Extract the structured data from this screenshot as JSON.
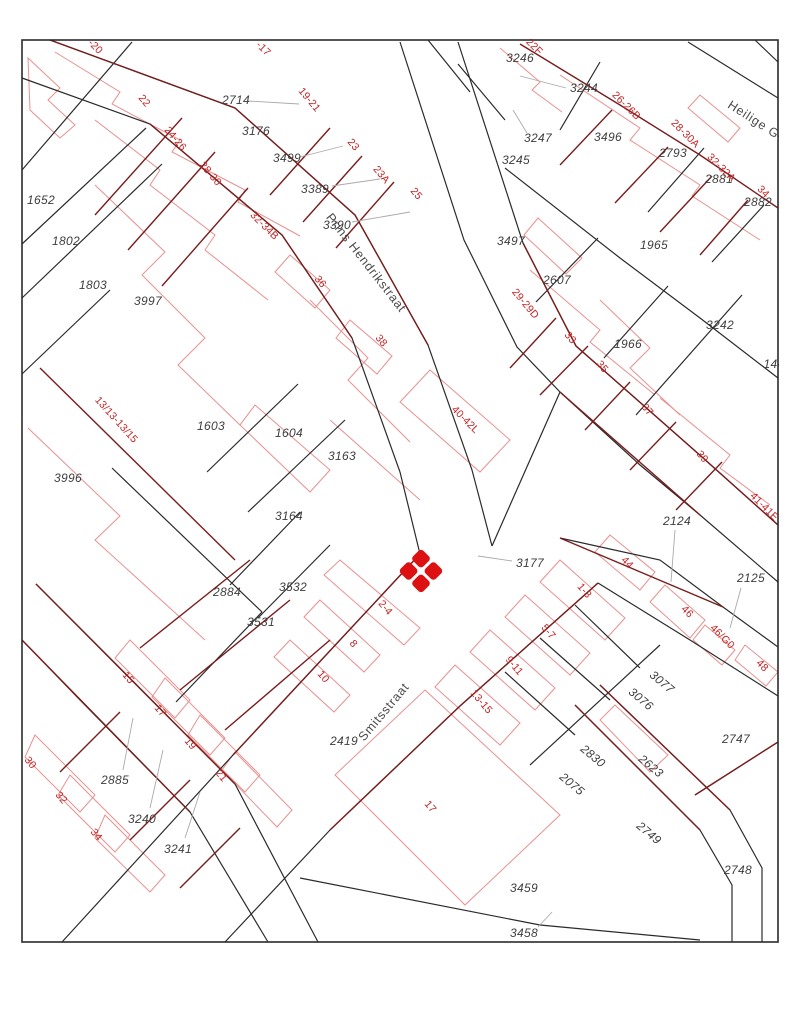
{
  "map": {
    "type": "cadastral-parcel-map",
    "colors": {
      "background": "#ffffff",
      "parcel_line": "#2b2b2b",
      "frontage_line": "#7a1d1d",
      "building_line": "#e89090",
      "parcel_label": "#3d3d3d",
      "house_label": "#c42222",
      "street_label": "#4a4a4a",
      "leader_line": "#aaaaaa",
      "marker": "#dd1111"
    },
    "marker": {
      "x": 421,
      "y": 571,
      "color": "#dd1111"
    },
    "streets": [
      {
        "name": "Prins Hendrikstraat",
        "x": 366,
        "y": 263,
        "rotation": 52
      },
      {
        "name": "Smitsstraat",
        "x": 384,
        "y": 712,
        "rotation": -50
      },
      {
        "name": "Heilige Gee",
        "x": 760,
        "y": 124,
        "rotation": 33
      }
    ],
    "parcel_numbers": [
      {
        "text": "2714",
        "x": 236,
        "y": 100,
        "rotation": 0
      },
      {
        "text": "3176",
        "x": 256,
        "y": 131,
        "rotation": 0
      },
      {
        "text": "3499",
        "x": 287,
        "y": 158,
        "rotation": 0
      },
      {
        "text": "3389",
        "x": 315,
        "y": 189,
        "rotation": 0
      },
      {
        "text": "3390",
        "x": 337,
        "y": 225,
        "rotation": 0
      },
      {
        "text": "1652",
        "x": 41,
        "y": 200,
        "rotation": 0
      },
      {
        "text": "1802",
        "x": 66,
        "y": 241,
        "rotation": 0
      },
      {
        "text": "1803",
        "x": 93,
        "y": 285,
        "rotation": 0
      },
      {
        "text": "3997",
        "x": 148,
        "y": 301,
        "rotation": 0
      },
      {
        "text": "3246",
        "x": 520,
        "y": 58,
        "rotation": 0
      },
      {
        "text": "3244",
        "x": 584,
        "y": 88,
        "rotation": 0
      },
      {
        "text": "3247",
        "x": 538,
        "y": 138,
        "rotation": 0
      },
      {
        "text": "3496",
        "x": 608,
        "y": 137,
        "rotation": 0
      },
      {
        "text": "3245",
        "x": 516,
        "y": 160,
        "rotation": 0
      },
      {
        "text": "2793",
        "x": 673,
        "y": 153,
        "rotation": 0
      },
      {
        "text": "2881",
        "x": 719,
        "y": 179,
        "rotation": 0
      },
      {
        "text": "2882",
        "x": 758,
        "y": 202,
        "rotation": 0
      },
      {
        "text": "3497",
        "x": 511,
        "y": 241,
        "rotation": 0
      },
      {
        "text": "2607",
        "x": 557,
        "y": 280,
        "rotation": 0
      },
      {
        "text": "1965",
        "x": 654,
        "y": 245,
        "rotation": 0
      },
      {
        "text": "1966",
        "x": 628,
        "y": 344,
        "rotation": 0
      },
      {
        "text": "3242",
        "x": 720,
        "y": 325,
        "rotation": 0
      },
      {
        "text": "144",
        "x": 774,
        "y": 364,
        "rotation": 0
      },
      {
        "text": "1603",
        "x": 211,
        "y": 426,
        "rotation": 0
      },
      {
        "text": "1604",
        "x": 289,
        "y": 433,
        "rotation": 0
      },
      {
        "text": "3163",
        "x": 342,
        "y": 456,
        "rotation": 0
      },
      {
        "text": "3164",
        "x": 289,
        "y": 516,
        "rotation": 0
      },
      {
        "text": "3996",
        "x": 68,
        "y": 478,
        "rotation": 0
      },
      {
        "text": "2124",
        "x": 677,
        "y": 521,
        "rotation": 0
      },
      {
        "text": "2125",
        "x": 751,
        "y": 578,
        "rotation": 0
      },
      {
        "text": "2884",
        "x": 227,
        "y": 592,
        "rotation": 0
      },
      {
        "text": "3532",
        "x": 293,
        "y": 587,
        "rotation": 0
      },
      {
        "text": "3531",
        "x": 261,
        "y": 622,
        "rotation": 0
      },
      {
        "text": "3177",
        "x": 530,
        "y": 563,
        "rotation": 0
      },
      {
        "text": "2419",
        "x": 344,
        "y": 741,
        "rotation": 0
      },
      {
        "text": "2885",
        "x": 115,
        "y": 780,
        "rotation": 0
      },
      {
        "text": "3240",
        "x": 142,
        "y": 819,
        "rotation": 0
      },
      {
        "text": "3241",
        "x": 178,
        "y": 849,
        "rotation": 0
      },
      {
        "text": "3077",
        "x": 662,
        "y": 682,
        "rotation": 40
      },
      {
        "text": "3076",
        "x": 641,
        "y": 699,
        "rotation": 40
      },
      {
        "text": "2830",
        "x": 593,
        "y": 756,
        "rotation": 40
      },
      {
        "text": "2075",
        "x": 572,
        "y": 784,
        "rotation": 40
      },
      {
        "text": "2623",
        "x": 651,
        "y": 766,
        "rotation": 40
      },
      {
        "text": "2747",
        "x": 736,
        "y": 739,
        "rotation": 0
      },
      {
        "text": "2749",
        "x": 649,
        "y": 833,
        "rotation": 40
      },
      {
        "text": "2748",
        "x": 738,
        "y": 870,
        "rotation": 0
      },
      {
        "text": "3459",
        "x": 524,
        "y": 888,
        "rotation": 0
      },
      {
        "text": "3458",
        "x": 524,
        "y": 933,
        "rotation": 0
      }
    ],
    "house_numbers": [
      {
        "text": "-20",
        "x": 95,
        "y": 47,
        "rotation": 45
      },
      {
        "text": "-17",
        "x": 263,
        "y": 49,
        "rotation": 45
      },
      {
        "text": "22",
        "x": 144,
        "y": 101,
        "rotation": 50
      },
      {
        "text": "24-26",
        "x": 175,
        "y": 139,
        "rotation": 50
      },
      {
        "text": "28-30",
        "x": 210,
        "y": 174,
        "rotation": 50
      },
      {
        "text": "19-21",
        "x": 309,
        "y": 100,
        "rotation": 50
      },
      {
        "text": "23",
        "x": 353,
        "y": 145,
        "rotation": 50
      },
      {
        "text": "23A",
        "x": 381,
        "y": 175,
        "rotation": 50
      },
      {
        "text": "25",
        "x": 416,
        "y": 194,
        "rotation": 50
      },
      {
        "text": "22F",
        "x": 534,
        "y": 47,
        "rotation": 45
      },
      {
        "text": "26-26B",
        "x": 626,
        "y": 106,
        "rotation": 45
      },
      {
        "text": "28-30A",
        "x": 685,
        "y": 134,
        "rotation": 45
      },
      {
        "text": "32-32A",
        "x": 721,
        "y": 168,
        "rotation": 45
      },
      {
        "text": "34",
        "x": 763,
        "y": 192,
        "rotation": 45
      },
      {
        "text": "32-34B",
        "x": 264,
        "y": 226,
        "rotation": 45
      },
      {
        "text": "36",
        "x": 320,
        "y": 282,
        "rotation": 50
      },
      {
        "text": "38",
        "x": 381,
        "y": 341,
        "rotation": 50
      },
      {
        "text": "29-29D",
        "x": 525,
        "y": 304,
        "rotation": 50
      },
      {
        "text": "33",
        "x": 570,
        "y": 338,
        "rotation": 50
      },
      {
        "text": "35",
        "x": 602,
        "y": 367,
        "rotation": 50
      },
      {
        "text": "37",
        "x": 647,
        "y": 410,
        "rotation": 50
      },
      {
        "text": "39",
        "x": 702,
        "y": 457,
        "rotation": 50
      },
      {
        "text": "41-41E",
        "x": 764,
        "y": 507,
        "rotation": 45
      },
      {
        "text": "40-42L",
        "x": 465,
        "y": 420,
        "rotation": 45
      },
      {
        "text": "13/13-13/15",
        "x": 116,
        "y": 420,
        "rotation": 48
      },
      {
        "text": "2-4",
        "x": 385,
        "y": 608,
        "rotation": 50
      },
      {
        "text": "8",
        "x": 353,
        "y": 644,
        "rotation": 50
      },
      {
        "text": "10",
        "x": 323,
        "y": 677,
        "rotation": 50
      },
      {
        "text": "1-3",
        "x": 584,
        "y": 591,
        "rotation": 50
      },
      {
        "text": "5-7",
        "x": 548,
        "y": 632,
        "rotation": 50
      },
      {
        "text": "9-11",
        "x": 514,
        "y": 666,
        "rotation": 50
      },
      {
        "text": "13-15",
        "x": 481,
        "y": 702,
        "rotation": 50
      },
      {
        "text": "44",
        "x": 627,
        "y": 563,
        "rotation": 45
      },
      {
        "text": "46",
        "x": 687,
        "y": 612,
        "rotation": 45
      },
      {
        "text": "46/G0",
        "x": 722,
        "y": 637,
        "rotation": 45
      },
      {
        "text": "48",
        "x": 762,
        "y": 666,
        "rotation": 45
      },
      {
        "text": "15",
        "x": 128,
        "y": 678,
        "rotation": 50
      },
      {
        "text": "17",
        "x": 160,
        "y": 711,
        "rotation": 50
      },
      {
        "text": "19",
        "x": 190,
        "y": 744,
        "rotation": 50
      },
      {
        "text": "21",
        "x": 221,
        "y": 776,
        "rotation": 50
      },
      {
        "text": "30",
        "x": 30,
        "y": 763,
        "rotation": 50
      },
      {
        "text": "32",
        "x": 61,
        "y": 798,
        "rotation": 50
      },
      {
        "text": "34",
        "x": 96,
        "y": 835,
        "rotation": 50
      },
      {
        "text": "17",
        "x": 430,
        "y": 807,
        "rotation": 50
      }
    ]
  }
}
